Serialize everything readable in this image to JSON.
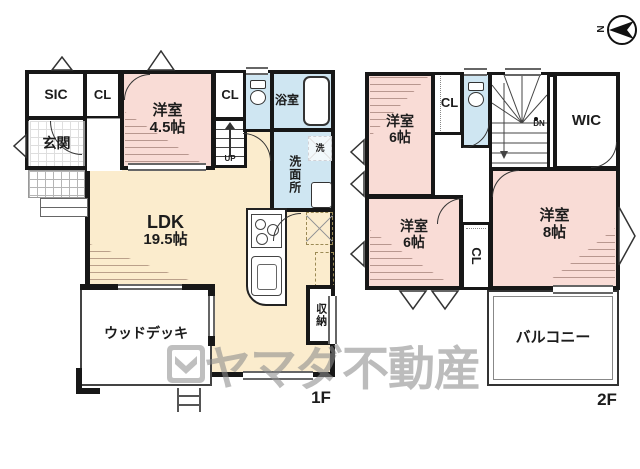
{
  "floor1": {
    "label": "1F",
    "sic": "SIC",
    "closet_a": "CL",
    "closet_b": "CL",
    "entrance": "玄関",
    "bedroom": {
      "name": "洋室",
      "size": "4.5帖"
    },
    "bath": "浴室",
    "washroom": "洗面所",
    "washer": "洗",
    "ldk": {
      "name": "LDK",
      "size": "19.5帖"
    },
    "stairs_up": "UP",
    "storage": "収納",
    "wood_deck": "ウッドデッキ"
  },
  "floor2": {
    "label": "2F",
    "bedroom_nw": {
      "name": "洋室",
      "size": "6帖"
    },
    "closet_top": "CL",
    "stairs_down": "DN",
    "wic": "WIC",
    "bedroom_e": {
      "name": "洋室",
      "size": "8帖"
    },
    "bedroom_sw": {
      "name": "洋室",
      "size": "6帖"
    },
    "closet_bottom": "CL",
    "balcony": "バルコニー"
  },
  "compass": {
    "north": "N"
  },
  "watermark": {
    "text": "ヤマダ不動産"
  },
  "colors": {
    "room_pink": "#f9dcd6",
    "room_cream": "#fbeccd",
    "room_blue": "#cfe6f2",
    "wall": "#171717",
    "watermark_gray": "#8c8c8c"
  }
}
